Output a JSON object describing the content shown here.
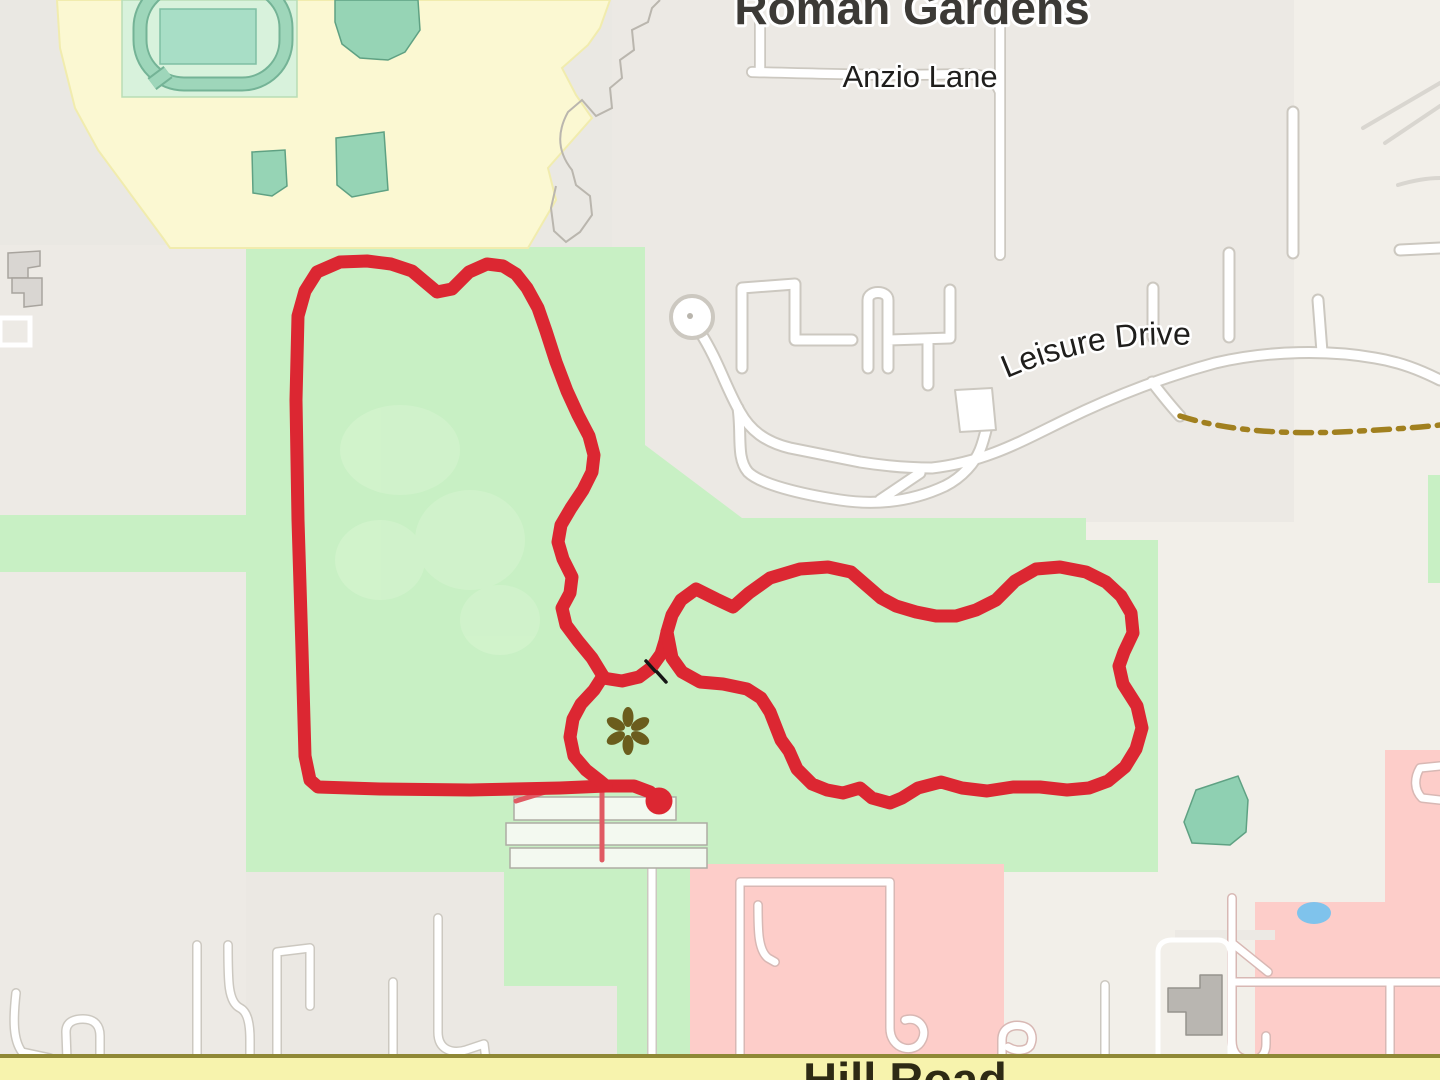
{
  "map": {
    "place_labels": {
      "roman_gardens": "Roman Gardens",
      "anzio_lane": "Anzio Lane",
      "leisure_drive": "Leisure Drive",
      "hill_road": "Hill Road"
    },
    "colors": {
      "base_beige": "#f2efe9",
      "residential_gray": "#ece9e3",
      "park_green": "#c8f0c4",
      "school_yellow": "#fbf8d2",
      "stadium_pitch": "#d8f2dc",
      "track_teal": "#9ed6ba",
      "field_teal": "#a8dec6",
      "building_teal": "#96d4b5",
      "pink_residential": "#fdcdc9",
      "pond_blue": "#7fc3ec",
      "road_casing": "#ccc8c0",
      "hill_road_fill": "#f7f3ad",
      "hill_road_casing": "#8f8836",
      "route_red": "#dc2732",
      "route_thin_red": "#e05a63",
      "dashed_path_brown": "#a1801f",
      "flower_olive": "#6b5d1d"
    },
    "route": {
      "color": "#dc2732",
      "width": "13",
      "main_loop": "603,676 592,658 578,641 566,625 562,608 570,593 572,577 563,559 558,542 561,525 571,508 583,490 592,472 594,455 589,436 578,415 567,391 556,362 546,331 538,308 527,288 516,274 503,266 487,264 469,272 452,289 437,292 412,271 391,264 367,261 340,262 317,272 305,291 298,316 296,400 298,520 302,650 305,756 310,780 318,787 380,789 470,790 560,788 606,786 634,786 650,792 658,800",
      "tail": "603,676 594,690 581,704 573,719 570,737 574,756 586,770 600,781 606,786",
      "connector": "603,678 622,681 639,677 651,668 661,654 665,641 667,632",
      "right_loop": "667,632 672,615 681,600 696,589 716,599 733,607 749,593 770,578 800,569 828,567 851,572 866,585 881,598 896,606 916,612 936,616 956,616 976,610 996,600 1015,581 1036,569 1060,567 1086,572 1106,582 1121,596 1131,613 1133,633 1124,652 1119,666 1123,684 1137,706 1142,728 1136,749 1125,767 1108,781 1089,788 1067,790 1040,787 1013,787 987,791 962,788 941,782 918,788 902,798 890,803 872,798 860,788 843,793 827,790 812,784 797,769 789,751 781,740 770,712 761,698 747,689 723,684 700,682 682,672 672,658",
      "thin_a": "602,788 602,860",
      "thin_b": "516,801 552,790",
      "endpoint_cx": "659",
      "endpoint_cy": "801",
      "endpoint_r": "13.5"
    },
    "icons": {
      "garden_flower": "garden-flower-icon",
      "gate_marks": "gate-icon"
    }
  }
}
